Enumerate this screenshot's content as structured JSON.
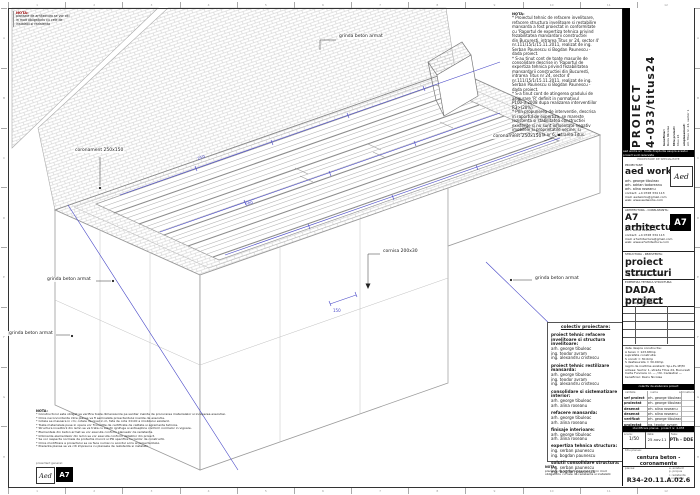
{
  "rulers": {
    "top": [
      "1",
      "2",
      "3",
      "4",
      "5",
      "6",
      "7",
      "8",
      "9",
      "10",
      "11",
      "12"
    ],
    "side": [
      "A",
      "B",
      "C",
      "D",
      "E",
      "F",
      "G",
      "H"
    ]
  },
  "corner_note": {
    "title": "NOTA:",
    "lines": [
      "plansele de arhitectura se vor citi",
      "in mod obligatoriu cu cele de",
      "instalatii si rezistenta"
    ]
  },
  "top_note": {
    "title": "NOTA:",
    "lines": [
      "* Proiectul tehnic de refacere invelitoare,",
      "refacere structura invelitoare si restabilire",
      "mansarda a fost proiectat in conformitate",
      "cu 'Raportul de expertiza tehnica privind",
      "fezabilitatea mansardarii constructiei",
      "din Bucuresti, intrarea Titus nr 24, sector 4'",
      "nr.111/15/1/15.11.2011, realizat de ing.",
      "Serban Paunescu si Bogdan Paunescu -",
      "dada proiect.",
      "* S-au tinut cont de toate masurile de",
      "consolidare descrise in 'Raportul de",
      "expertiza tehnica privind fezabilitatea",
      "mansardarii constructiei din Bucuresti,",
      "intrarea Titus nr 24, sector 4'",
      "nr.111/15/1/15.11.2011, realizat de ing.",
      "Serban Paunescu si Bogdan Paunescu -",
      "dada proiect.",
      "* S-a tinut cont de atingerea gradului de",
      "asigurare 'R' definit in normativul",
      "P100-3:2008 dupa realizarea interventiilor",
      "R3>(20%)",
      "* Prin propunerea de interventie, descrisa",
      "in raportul de expertiza, se mareste",
      "rezistenta si stabilitatea constructiei",
      "existente si nu sunt influentate negativ",
      "imobilele si proprietatile vecine, si",
      "constructia de la nr 6, intrarea Titus."
    ]
  },
  "bottom_note": {
    "title": "NOTA:",
    "lines": [
      "* Constructorul este obligat sa verifice toate dimensiunile pe santier inainte de procurarea materialelor si inceperea executiei.",
      "* Orice neconcordanta intre planse va fi semnalata proiectantului inainte de executie.",
      "* Cotele se masoara in cm; cotele de nivel in m, fata de cota ±0.00 a imobilului existent.",
      "* Toate materialele puse in opera vor fi insotite de certificate de calitate si agremente tehnice.",
      "* Structura invelitorii din lemn se va trata cu solutii ignifuge si antiseptice conform normelor in vigoare.",
      "* Elementele din beton armat se vor executa conform planselor de rezistenta.",
      "* Imbinarile elementelor din lemn se vor executa conform detaliilor din proiect.",
      "* Se vor respecta normele de protectia muncii si PSI specifice lucrarilor de constructii.",
      "* Orice modificare a proiectului se va face numai cu acordul scris al proiectantului.",
      "* Prezenta plansa se va citi impreuna cu plansele de rezistenta si instalatii."
    ]
  },
  "footer_note": {
    "title": "NOTA:",
    "lines": [
      "plansele de arhitectura se vor citi in mod",
      "obligatoriu cu cele de rezistenta si instalatii"
    ]
  },
  "logos": {
    "caption": "proiectant general:",
    "aed": "Aed",
    "a7": "A7"
  },
  "drawing": {
    "labels": {
      "l1": "grinda beton armat",
      "l2": "coronament 250x150",
      "l3": "coronament 250x150",
      "l4": "cornisa 200x30",
      "l5": "grinda beton armat",
      "l6": "grinda beton armat",
      "l7": "grinda beton armat"
    },
    "dims": {
      "d1": "250",
      "d2": "200",
      "d3": "150"
    }
  },
  "legend": {
    "title": "colectiv proiectare:",
    "groups": [
      {
        "role": "proiect tehnic refacere invelitoare si structura invelitoare:",
        "names": [
          "arh. george tibuleac",
          "ing. teodor avram",
          "ing. alexandru cristescu"
        ]
      },
      {
        "role": "proiect tehnic restilizare mansarda:",
        "names": [
          "arh. george tibuleac",
          "ing. teodor avram",
          "ing. alexandru cristescu"
        ]
      },
      {
        "role": "consolidare si sistematizare interior:",
        "names": [
          "arh. george tibuleac",
          "arh. alina roseanu"
        ]
      },
      {
        "role": "refacere mansarda:",
        "names": [
          "arh. george tibuleac",
          "arh. alina roseanu"
        ]
      },
      {
        "role": "finisaje interioare:",
        "names": [
          "arh. george tibuleac",
          "arh. alina roseanu"
        ]
      },
      {
        "role": "expertiza tehnica structura:",
        "names": [
          "ing. serban paunescu",
          "ing. bogdan paunescu"
        ]
      },
      {
        "role": "solutii consolidare structura:",
        "names": [
          "ing. serban paunescu",
          "ing. bogdan paunescu"
        ]
      }
    ]
  },
  "titleblock": {
    "project_title_1": "PROIECT",
    "project_title_2": "4-033/titus24",
    "beneficiar_label": "beneficiar:",
    "beneficiar": "Raicu Nicolae",
    "titlu_label": "titlu proiect:",
    "titlu": "titus 24",
    "amplasament_label": "amplasament:",
    "amplasament": "str. Titus nr. 24, sector 1",
    "strip1": "aed works srl · toate drepturile asupra acestui proiect sunt rezervate",
    "spec_label": "PROIECTARE DE SPECIALITATE",
    "proiectant": {
      "label": "PROIECTANT:",
      "name": "aed works.",
      "people": [
        "arh. george tibuleac",
        "arh. adrian todoreanu",
        "arh. alina roseanu"
      ],
      "contact": [
        "contact: +4 0728 334 113",
        "mail: aedworks@gmail.com",
        "web: www.aedworks.com"
      ]
    },
    "arhitectura": {
      "label": "ARHITECTURA - CONSULTANTA:",
      "name": "A7 arhitectura.",
      "people": [
        "arh. george tibuleac",
        "arh. alina roseanu"
      ],
      "contact": [
        "contact: +4 0728 334 113",
        "mail: a7arhitectura@gmail.com",
        "web: www.a7arhitectura.com"
      ]
    },
    "structura": {
      "label": "STRUCTURA - REZISTENTA:",
      "name": "proiect structuri",
      "people": [
        "ing. teodor avram",
        "ing. alexandru cristescu"
      ]
    },
    "expertiza": {
      "label": "EXPERTIZA TEHNICA STRUCTURA:",
      "name": "DADA project",
      "people": [
        "ing. serban paunescu",
        "ing. bogdan paunescu"
      ]
    },
    "building_data": {
      "lines": [
        "date despre constructie:",
        "A teren = 123.68mp",
        "suprafata construita:",
        "S constr = 30.0mp",
        "S desfasurata = 30.00mp",
        "regim de inaltime existent: Sp+P+1E/M",
        "adresa: Sector 1, strada Titus 24, Bucuresti",
        "Carte Funciara nr. — / Nr. Cadastral —",
        "beneficiar: Raicu Nicolae"
      ]
    },
    "strip2": "colectiv de elaborare proiect",
    "sig_header": {
      "c1": "calitate",
      "c2": "nume",
      "c3": "semnatura"
    },
    "sig_rows": [
      [
        "sef proiect",
        "arh. george tibuleac"
      ],
      [
        "proiectat",
        "arh. george tibuleac"
      ],
      [
        "desenat",
        "arh. alina roseanu"
      ],
      [
        "desenat",
        "arh. alina roseanu"
      ],
      [
        "verificat",
        "arh. george tibuleac"
      ],
      [
        "proiectat",
        "ing. teodor avram"
      ],
      [
        "verificat",
        "ing. alexandru cristescu"
      ]
    ],
    "strip3": "identificare plansa · proiect nr. 4-033",
    "scara_label": "scara:",
    "scara": "1/50",
    "data_label": "data:",
    "data": "25.nov.11",
    "faza_label": "faza:",
    "faza": "PTh - DDE",
    "titlu_plansa_label": "titlu plansa:",
    "titlu_plansa": "centura beton - coronamente",
    "plansa_label": "plansa:",
    "mini_list": [
      "e. existent",
      "p. propus",
      "r. rezistenta",
      "i. instalatii"
    ],
    "plansa_cod": "R34-20.11.A.02.6"
  }
}
